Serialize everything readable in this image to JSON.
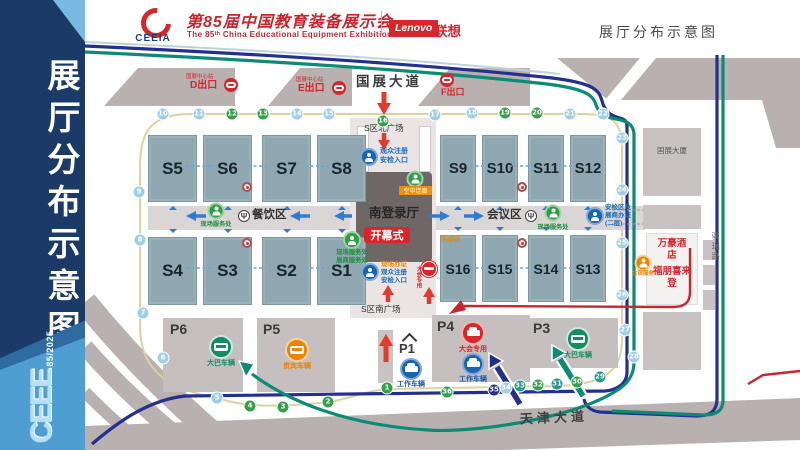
{
  "banner": {
    "vertical_title": "展厅分布示意图",
    "logo_text": "CEEE",
    "logo_sub": "85/2025"
  },
  "header": {
    "logo_acronym": "CEEIA",
    "title_cn": "第85届中国教育装备展示会",
    "title_en": "The 85ᵗʰ China Educational Equipment Exhibition",
    "lenovo": "Lenovo",
    "lenovo_cn": "联想",
    "page_title": "展厅分布示意图"
  },
  "map": {
    "roads": {
      "north": "国展大道",
      "south": "天津大道",
      "east": "骥瑞路"
    },
    "metro": {
      "station": "国展中心站",
      "exit_d": "D出口",
      "exit_e": "E出口",
      "exit_f": "F出口"
    },
    "halls": {
      "nw": [
        "S5",
        "S6",
        "S7",
        "S8"
      ],
      "ne": [
        "S9",
        "S10",
        "S11",
        "S12"
      ],
      "sw": [
        "S4",
        "S3",
        "S2",
        "S1"
      ],
      "se": [
        "S16",
        "S15",
        "S14",
        "S13"
      ]
    },
    "plazas": {
      "north": "S区北广场",
      "south": "S区南广场"
    },
    "center": {
      "login_hall": "南登录厅",
      "opening": "开幕式",
      "badge": "现场办证",
      "reg_line1": "观众注册",
      "reg_line2": "安检入口",
      "service_line1": "现场服务处",
      "service_line2": "展商服务处",
      "bridge": "空中连廊",
      "vip_only": "大会专用",
      "activity": "活动区"
    },
    "west_corridor": {
      "label": "餐饮区",
      "service": "现场服务处"
    },
    "east_corridor": {
      "label": "会议区",
      "service": "现场服务处",
      "sec_line1": "安检区及",
      "sec_line2": "展商办证",
      "sec_line3": "(二层)"
    },
    "buildings": {
      "tower": "国展大厦",
      "hotel_a": "万豪酒店",
      "hotel_b": "福朋喜来登",
      "hotel_service": "住宿服务"
    },
    "parking": {
      "p1": "P1",
      "p3": "P3",
      "p4": "P4",
      "p5": "P5",
      "p6": "P6",
      "bus": "大巴车辆",
      "work": "工作车辆",
      "vip": "贵宾车辆",
      "dedicated": "大会专用"
    },
    "route_stops": [
      {
        "n": 1,
        "x": 387,
        "y": 388,
        "c": "g"
      },
      {
        "n": 2,
        "x": 328,
        "y": 402,
        "c": "g"
      },
      {
        "n": 3,
        "x": 283,
        "y": 407,
        "c": "g"
      },
      {
        "n": 4,
        "x": 250,
        "y": 406,
        "c": "g"
      },
      {
        "n": 5,
        "x": 217,
        "y": 398,
        "c": "b"
      },
      {
        "n": 6,
        "x": 163,
        "y": 358,
        "c": "b"
      },
      {
        "n": 7,
        "x": 143,
        "y": 313,
        "c": "b"
      },
      {
        "n": 8,
        "x": 140,
        "y": 240,
        "c": "b"
      },
      {
        "n": 9,
        "x": 139,
        "y": 192,
        "c": "b"
      },
      {
        "n": 10,
        "x": 163,
        "y": 114,
        "c": "b"
      },
      {
        "n": 11,
        "x": 199,
        "y": 114,
        "c": "b"
      },
      {
        "n": 12,
        "x": 232,
        "y": 114,
        "c": "g"
      },
      {
        "n": 13,
        "x": 263,
        "y": 114,
        "c": "g"
      },
      {
        "n": 14,
        "x": 297,
        "y": 114,
        "c": "b"
      },
      {
        "n": 15,
        "x": 329,
        "y": 114,
        "c": "b"
      },
      {
        "n": 16,
        "x": 383,
        "y": 121,
        "c": "g"
      },
      {
        "n": 17,
        "x": 435,
        "y": 115,
        "c": "b"
      },
      {
        "n": 18,
        "x": 472,
        "y": 113,
        "c": "b"
      },
      {
        "n": 19,
        "x": 505,
        "y": 113,
        "c": "g"
      },
      {
        "n": 20,
        "x": 537,
        "y": 113,
        "c": "g"
      },
      {
        "n": 21,
        "x": 570,
        "y": 114,
        "c": "b"
      },
      {
        "n": 22,
        "x": 603,
        "y": 114,
        "c": "b"
      },
      {
        "n": 23,
        "x": 622,
        "y": 138,
        "c": "b"
      },
      {
        "n": 24,
        "x": 622,
        "y": 190,
        "c": "b"
      },
      {
        "n": 25,
        "x": 622,
        "y": 243,
        "c": "b"
      },
      {
        "n": 26,
        "x": 622,
        "y": 295,
        "c": "b"
      },
      {
        "n": 27,
        "x": 625,
        "y": 330,
        "c": "b"
      },
      {
        "n": 28,
        "x": 634,
        "y": 357,
        "c": "b"
      },
      {
        "n": 29,
        "x": 600,
        "y": 377,
        "c": "t"
      },
      {
        "n": 30,
        "x": 577,
        "y": 382,
        "c": "g"
      },
      {
        "n": 31,
        "x": 557,
        "y": 384,
        "c": "t"
      },
      {
        "n": 32,
        "x": 538,
        "y": 385,
        "c": "g"
      },
      {
        "n": 33,
        "x": 520,
        "y": 386,
        "c": "t"
      },
      {
        "n": 34,
        "x": 506,
        "y": 388,
        "c": "b"
      },
      {
        "n": 35,
        "x": 494,
        "y": 390,
        "c": "n"
      },
      {
        "n": 36,
        "x": 447,
        "y": 392,
        "c": "g"
      }
    ]
  }
}
